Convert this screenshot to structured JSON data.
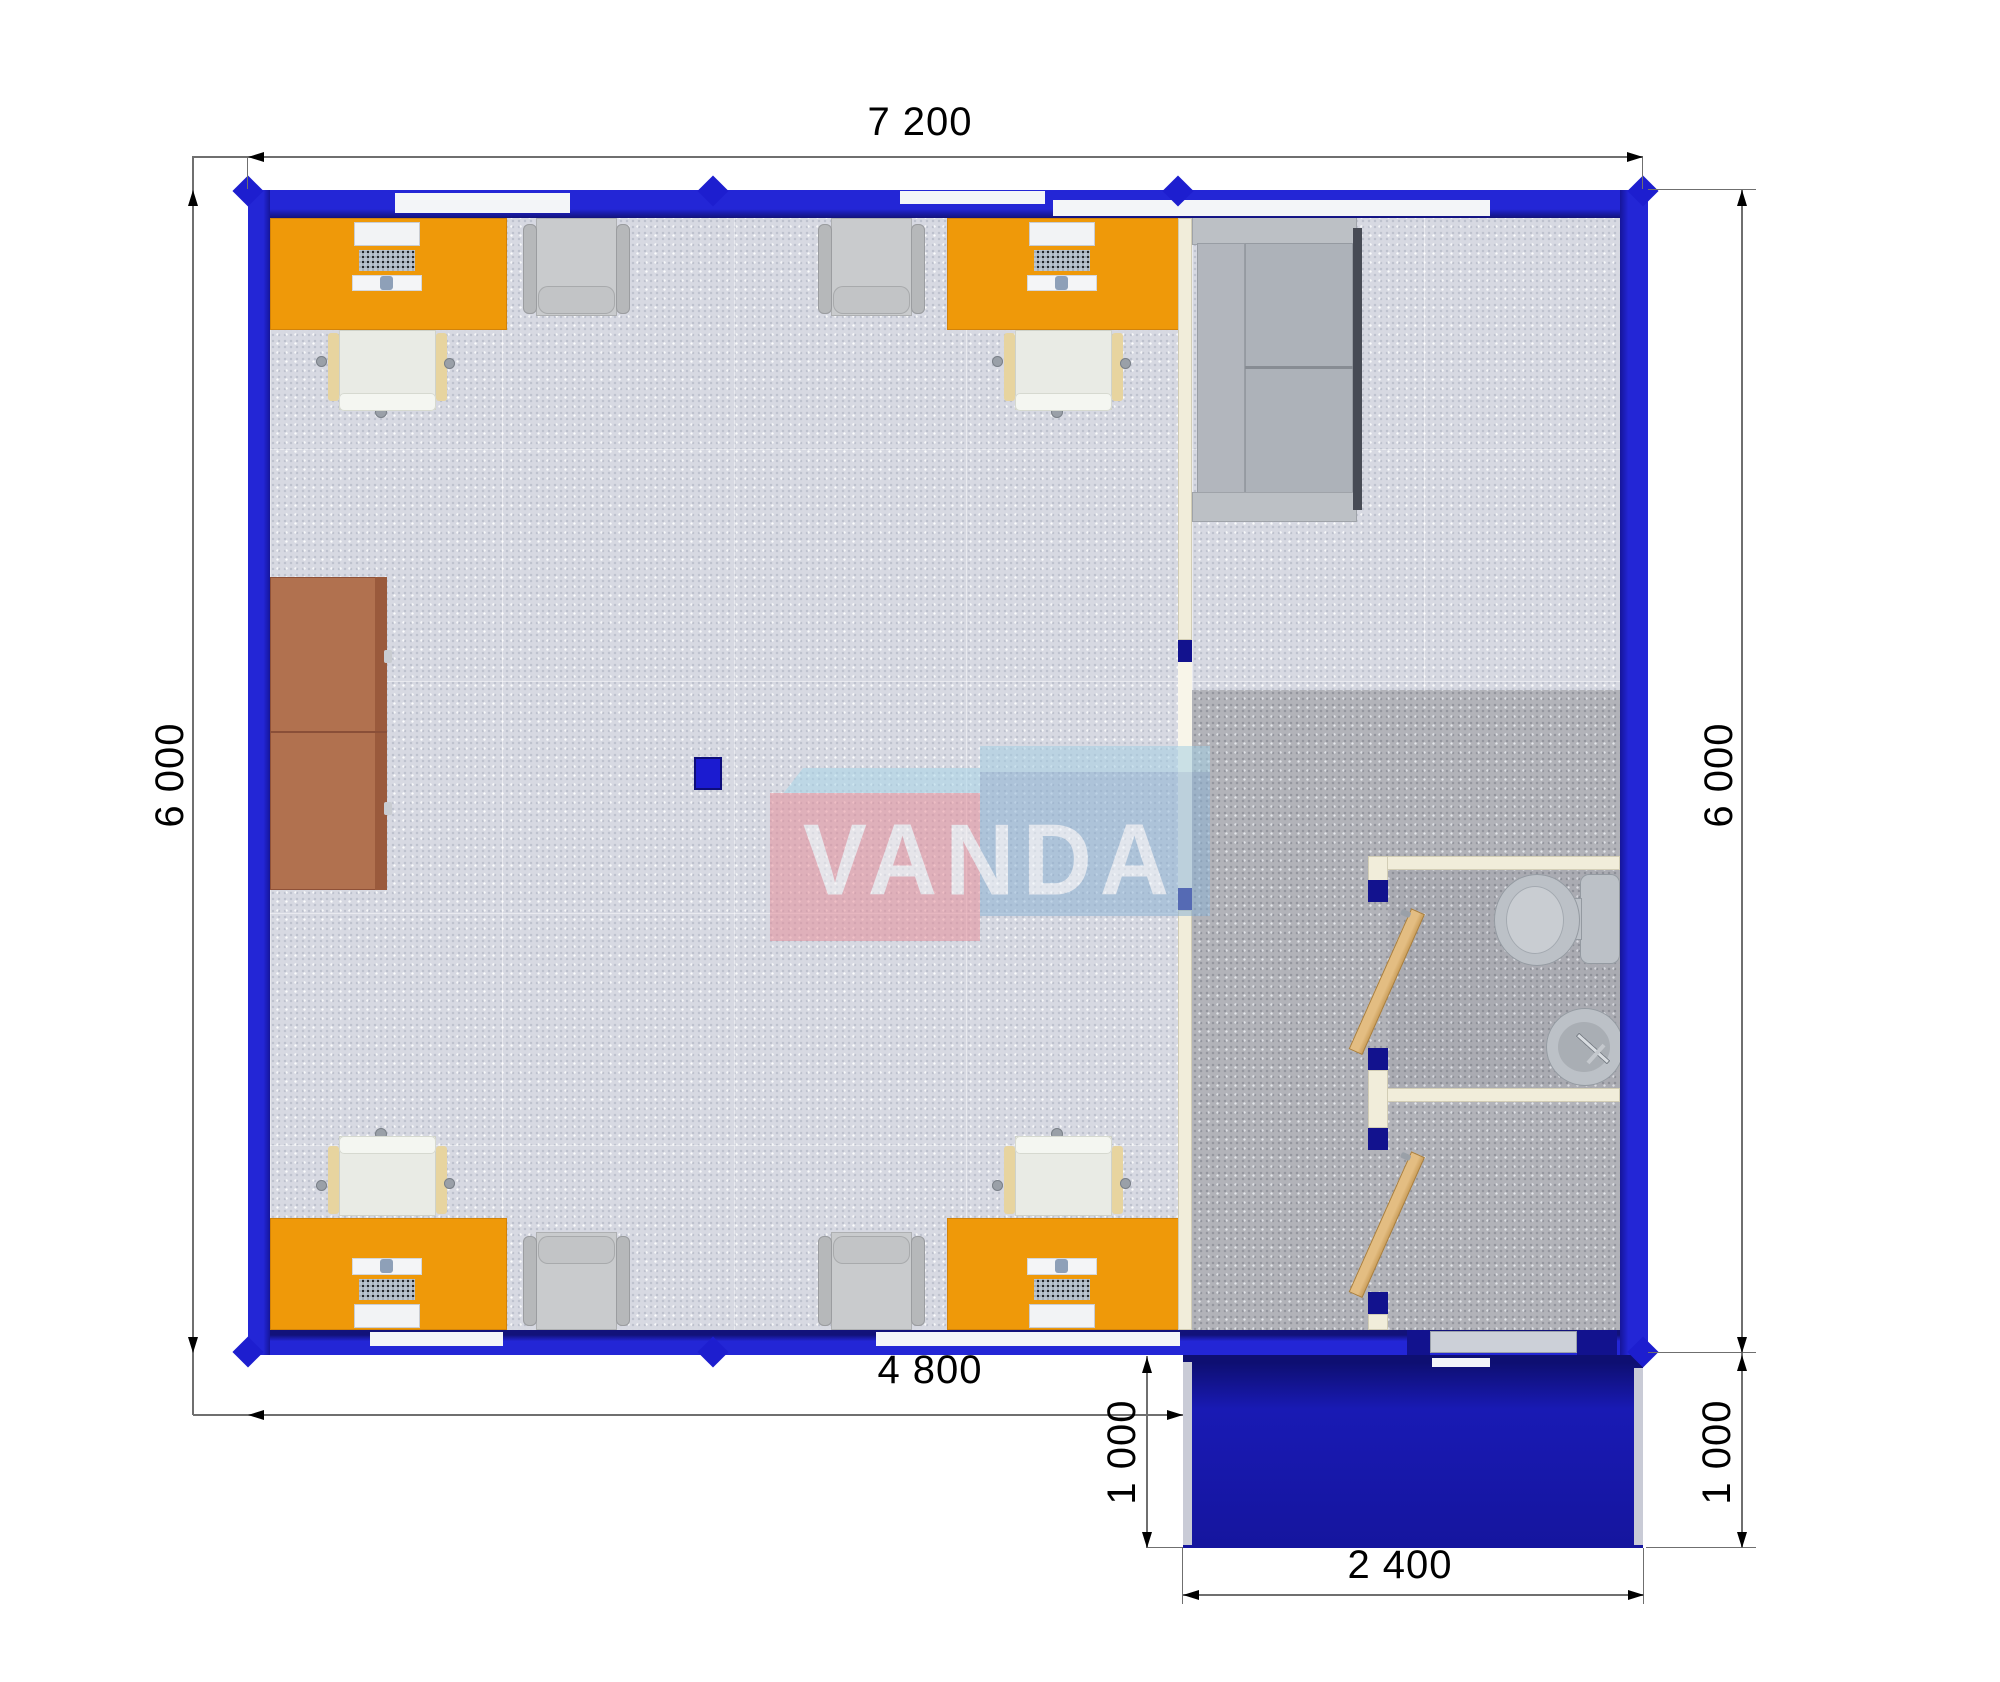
{
  "title": "Modular office container floor plan",
  "watermark": {
    "text": "VANDA",
    "box_left_color": "#e78f9b",
    "box_right_color": "#8cb2d3",
    "top_face_color": "#a9d6e8"
  },
  "dimensions": {
    "top_width": "7 200",
    "left_height": "6 000",
    "right_height": "6 000",
    "interior_bottom_width": "4 800",
    "porch_depth_left": "1 000",
    "porch_depth_right": "1 000",
    "porch_width": "2 400"
  },
  "colors": {
    "wall_blue": "#2326d6",
    "porch_blue": "#15159e",
    "desk_orange": "#ef9909",
    "cabinet_brown": "#b1714f",
    "floor_office": "#d7d9e2",
    "floor_hall": "#b2b3b9",
    "partition_cream": "#f1edda",
    "door_wood": "#e3bd82",
    "sofa_gray": "#adb2b9",
    "armchair_gray": "#c9cbcd",
    "chair_seat_cream": "#e9ebe5",
    "fixture_gray": "#bcc1c7",
    "floor_marker_blue": "#1b1bd0"
  }
}
